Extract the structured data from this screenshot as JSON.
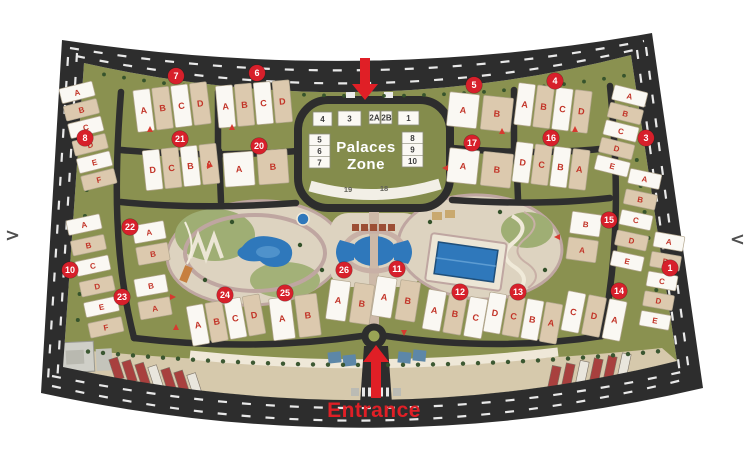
{
  "nav": {
    "left": ">",
    "right": "<"
  },
  "colors": {
    "field": "#8a9150",
    "road": "#2d2d2d",
    "plaza": "#d6c9ac",
    "park": "#ddd3c0",
    "park_ring": "#bfa6a1",
    "pool": "#2f78bb",
    "slab_white": "#faf8f3",
    "slab_tan": "#dcc9ae",
    "slab_border": "#b3a78f",
    "letter_red": "#c23327",
    "badge_red": "#d7202b",
    "accent_red": "#e01f26",
    "canopy_red": "#a8403e",
    "canopy_white": "#e9e6dd",
    "tree_green": "#33512a",
    "dash_white": "#e9e9e9"
  },
  "map": {
    "palaces": {
      "title_line1": "Palaces",
      "title_line2": "Zone",
      "top_row": [
        {
          "label": "4",
          "x": 313,
          "y": 112,
          "w": 19,
          "h": 14
        },
        {
          "label": "3",
          "x": 338,
          "y": 111,
          "w": 23,
          "h": 15
        },
        {
          "label": "2A",
          "x": 369,
          "y": 111,
          "w": 11,
          "h": 13
        },
        {
          "label": "2B",
          "x": 381,
          "y": 111,
          "w": 11,
          "h": 13
        },
        {
          "label": "1",
          "x": 398,
          "y": 111,
          "w": 21,
          "h": 14
        }
      ],
      "left_stack": {
        "x": 309,
        "y": 134,
        "w": 21,
        "h": 34,
        "labels": [
          "5",
          "6",
          "7"
        ]
      },
      "right_stack": {
        "x": 402,
        "y": 132,
        "w": 21,
        "h": 35,
        "labels": [
          "8",
          "9",
          "10"
        ]
      },
      "arc_labels": [
        {
          "label": "19",
          "x": 348,
          "y": 192
        },
        {
          "label": "18",
          "x": 384,
          "y": 191
        }
      ]
    },
    "entrance": {
      "label": "Entrance"
    },
    "markers": [
      {
        "n": "7",
        "x": 176,
        "y": 76
      },
      {
        "n": "6",
        "x": 257,
        "y": 73
      },
      {
        "n": "5",
        "x": 474,
        "y": 85
      },
      {
        "n": "4",
        "x": 555,
        "y": 81
      },
      {
        "n": "8",
        "x": 85,
        "y": 138
      },
      {
        "n": "21",
        "x": 180,
        "y": 139
      },
      {
        "n": "20",
        "x": 259,
        "y": 146
      },
      {
        "n": "17",
        "x": 472,
        "y": 143
      },
      {
        "n": "16",
        "x": 551,
        "y": 138
      },
      {
        "n": "3",
        "x": 646,
        "y": 138
      },
      {
        "n": "22",
        "x": 130,
        "y": 227
      },
      {
        "n": "10",
        "x": 70,
        "y": 270
      },
      {
        "n": "23",
        "x": 122,
        "y": 297
      },
      {
        "n": "15",
        "x": 609,
        "y": 220
      },
      {
        "n": "1",
        "x": 670,
        "y": 268
      },
      {
        "n": "14",
        "x": 619,
        "y": 291
      },
      {
        "n": "24",
        "x": 225,
        "y": 295
      },
      {
        "n": "25",
        "x": 285,
        "y": 293
      },
      {
        "n": "26",
        "x": 344,
        "y": 270
      },
      {
        "n": "11",
        "x": 397,
        "y": 269
      },
      {
        "n": "12",
        "x": 460,
        "y": 292
      },
      {
        "n": "13",
        "x": 518,
        "y": 292
      }
    ],
    "clusters": [
      {
        "x": 172,
        "y": 107,
        "rot": -7,
        "dir": "row",
        "w": 17,
        "h": 42,
        "gap": 19,
        "letters": [
          "A",
          "B",
          "C",
          "D"
        ]
      },
      {
        "x": 254,
        "y": 104,
        "rot": -5,
        "dir": "row",
        "w": 17,
        "h": 42,
        "gap": 19,
        "letters": [
          "A",
          "B",
          "C",
          "D"
        ]
      },
      {
        "x": 480,
        "y": 112,
        "rot": 6,
        "dir": "row",
        "w": 30,
        "h": 34,
        "gap": 34,
        "letters": [
          "A",
          "B"
        ]
      },
      {
        "x": 553,
        "y": 108,
        "rot": 7,
        "dir": "row",
        "w": 17,
        "h": 42,
        "gap": 19,
        "letters": [
          "A",
          "B",
          "C",
          "D"
        ]
      },
      {
        "x": 181,
        "y": 167,
        "rot": -6,
        "dir": "row",
        "w": 17,
        "h": 40,
        "gap": 19,
        "letters": [
          "D",
          "C",
          "B",
          "A"
        ]
      },
      {
        "x": 256,
        "y": 168,
        "rot": -4,
        "dir": "row",
        "w": 30,
        "h": 34,
        "gap": 34,
        "letters": [
          "A",
          "B"
        ]
      },
      {
        "x": 480,
        "y": 168,
        "rot": 6,
        "dir": "row",
        "w": 30,
        "h": 34,
        "gap": 34,
        "letters": [
          "A",
          "B"
        ]
      },
      {
        "x": 551,
        "y": 166,
        "rot": 7,
        "dir": "row",
        "w": 17,
        "h": 40,
        "gap": 19,
        "letters": [
          "D",
          "C",
          "B",
          "A"
        ]
      },
      {
        "x": 226,
        "y": 320,
        "rot": -10,
        "dir": "row",
        "w": 17,
        "h": 40,
        "gap": 19,
        "letters": [
          "A",
          "B",
          "C",
          "D"
        ]
      },
      {
        "x": 295,
        "y": 317,
        "rot": -7,
        "dir": "row",
        "w": 22,
        "h": 42,
        "gap": 26,
        "letters": [
          "A",
          "B"
        ]
      },
      {
        "x": 350,
        "y": 302,
        "rot": 8,
        "dir": "row",
        "w": 20,
        "h": 40,
        "gap": 24,
        "letters": [
          "A",
          "B"
        ]
      },
      {
        "x": 396,
        "y": 299,
        "rot": 9,
        "dir": "row",
        "w": 20,
        "h": 40,
        "gap": 24,
        "letters": [
          "A",
          "B"
        ]
      },
      {
        "x": 455,
        "y": 314,
        "rot": 10,
        "dir": "row",
        "w": 18,
        "h": 40,
        "gap": 21,
        "letters": [
          "A",
          "B",
          "C"
        ]
      },
      {
        "x": 523,
        "y": 318,
        "rot": 10,
        "dir": "row",
        "w": 17,
        "h": 40,
        "gap": 19,
        "letters": [
          "D",
          "C",
          "B",
          "A"
        ]
      },
      {
        "x": 594,
        "y": 316,
        "rot": 11,
        "dir": "row",
        "w": 18,
        "h": 40,
        "gap": 21,
        "letters": [
          "C",
          "D",
          "A"
        ]
      },
      {
        "x": 88,
        "y": 136,
        "rot": -14,
        "dir": "col",
        "w": 34,
        "h": 15,
        "gap": 18,
        "letters": [
          "A",
          "B",
          "C",
          "D",
          "E",
          "F"
        ]
      },
      {
        "x": 95,
        "y": 276,
        "rot": -12,
        "dir": "col",
        "w": 34,
        "h": 15,
        "gap": 21,
        "letters": [
          "A",
          "B",
          "C",
          "D",
          "E",
          "F"
        ]
      },
      {
        "x": 621,
        "y": 131,
        "rot": 14,
        "dir": "col",
        "w": 34,
        "h": 15,
        "gap": 18,
        "letters": [
          "A",
          "B",
          "C",
          "D",
          "E"
        ]
      },
      {
        "x": 636,
        "y": 220,
        "rot": 12,
        "dir": "col",
        "w": 32,
        "h": 15,
        "gap": 21,
        "letters": [
          "A",
          "B",
          "C",
          "D",
          "E"
        ]
      },
      {
        "x": 584,
        "y": 237,
        "rot": 8,
        "dir": "col",
        "w": 30,
        "h": 22,
        "gap": 26,
        "letters": [
          "B",
          "A"
        ]
      },
      {
        "x": 151,
        "y": 243,
        "rot": -10,
        "dir": "col",
        "w": 32,
        "h": 18,
        "gap": 22,
        "letters": [
          "A",
          "B"
        ]
      },
      {
        "x": 153,
        "y": 297,
        "rot": -10,
        "dir": "col",
        "w": 32,
        "h": 18,
        "gap": 23,
        "letters": [
          "B",
          "A"
        ]
      },
      {
        "x": 662,
        "y": 281,
        "rot": 10,
        "dir": "col",
        "w": 30,
        "h": 15,
        "gap": 20,
        "letters": [
          "A",
          "B",
          "C",
          "D",
          "E"
        ]
      }
    ]
  }
}
